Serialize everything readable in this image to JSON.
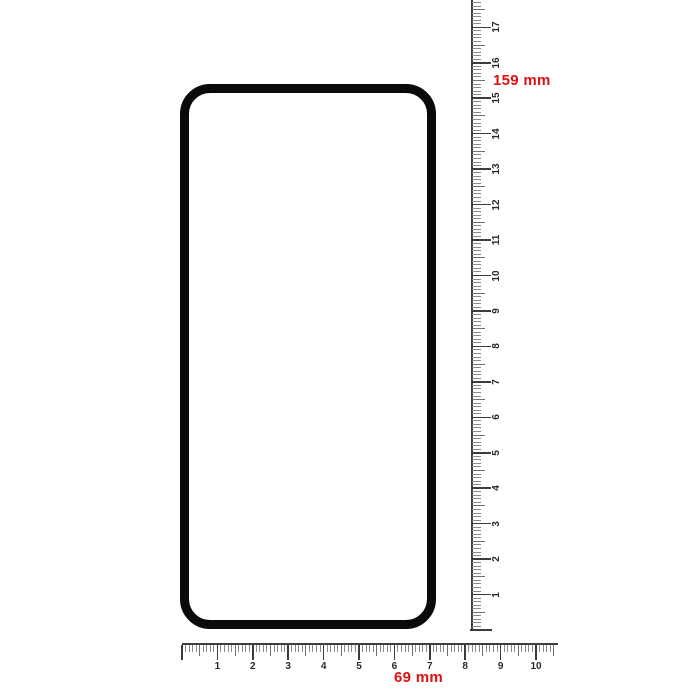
{
  "canvas": {
    "background": "#ffffff"
  },
  "protector": {
    "outline_color": "#0a0a0a"
  },
  "dimensions": {
    "height_label": "159 mm",
    "width_label": "69 mm",
    "label_color": "#dd1111"
  },
  "vertical_ruler": {
    "unit": "cm",
    "cm_labels": [
      "1",
      "2",
      "3",
      "4",
      "5",
      "6",
      "7",
      "8",
      "9",
      "10",
      "11",
      "12",
      "13",
      "14",
      "15",
      "16",
      "17"
    ]
  },
  "horizontal_ruler": {
    "unit": "cm",
    "cm_labels": [
      "1",
      "2",
      "3",
      "4",
      "5",
      "6",
      "7",
      "8",
      "9",
      "10"
    ]
  }
}
